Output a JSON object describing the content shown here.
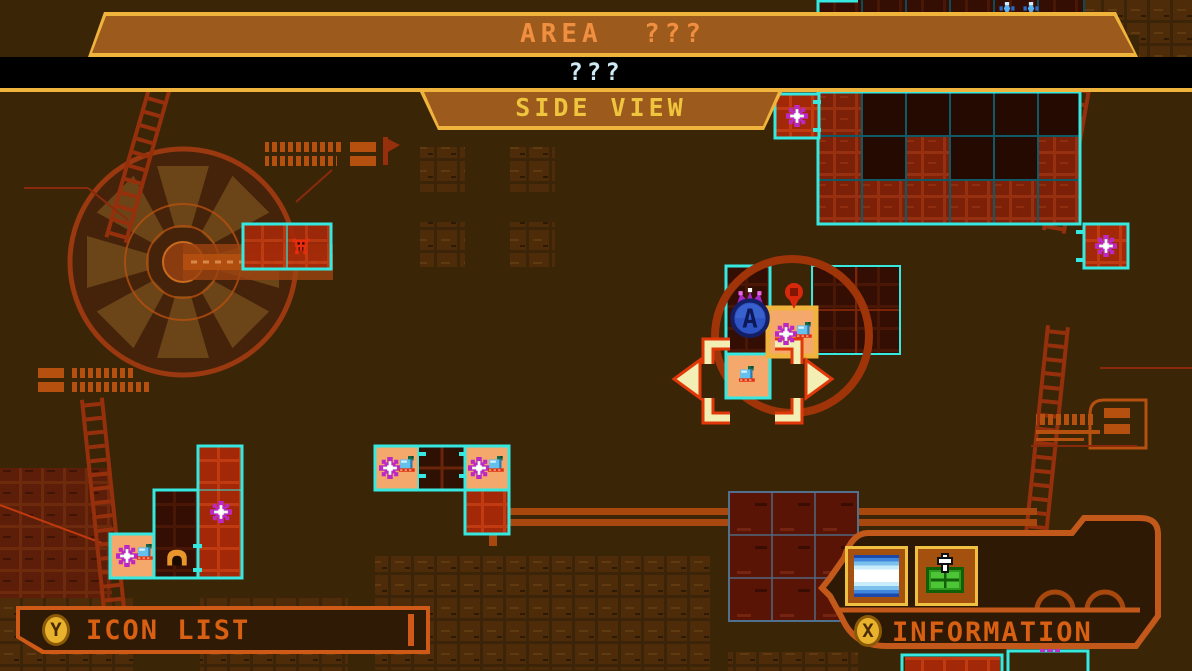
{
  "header": {
    "area_label": "AREA  ???",
    "subtitle": "???",
    "view_label": "SIDE VIEW"
  },
  "panels": {
    "icon_list": {
      "button_key": "Y",
      "label": "ICON LIST"
    },
    "information": {
      "button_key": "X",
      "label": "INFORMATION",
      "slots": [
        {
          "icon": "waterfall-icon"
        },
        {
          "icon": "map-chip-icon"
        }
      ]
    }
  },
  "map": {
    "markers": [
      {
        "type": "skull",
        "x": 301,
        "y": 247
      },
      {
        "type": "flower",
        "x": 797,
        "y": 116
      },
      {
        "type": "flower",
        "x": 1106,
        "y": 246
      },
      {
        "type": "flower",
        "x": 786,
        "y": 334
      },
      {
        "type": "tank",
        "x": 805,
        "y": 331
      },
      {
        "type": "tank",
        "x": 748,
        "y": 375
      },
      {
        "type": "flower",
        "x": 221,
        "y": 512
      },
      {
        "type": "flower",
        "x": 127,
        "y": 556
      },
      {
        "type": "tank",
        "x": 146,
        "y": 553
      },
      {
        "type": "dome",
        "x": 177,
        "y": 557
      },
      {
        "type": "flower",
        "x": 390,
        "y": 468
      },
      {
        "type": "tank",
        "x": 408,
        "y": 465
      },
      {
        "type": "flower",
        "x": 479,
        "y": 468
      },
      {
        "type": "tank",
        "x": 497,
        "y": 465
      },
      {
        "type": "sparkle",
        "x": 1007,
        "y": 9
      },
      {
        "type": "sparkle",
        "x": 1031,
        "y": 9
      },
      {
        "type": "pin",
        "x": 794,
        "y": 292
      },
      {
        "type": "player",
        "x": 750,
        "y": 318
      }
    ]
  },
  "colors": {
    "background": "#3a2507",
    "banner_fill": "#9c5a1d",
    "gold": "#f0b43c",
    "area_text": "#ef8f3f",
    "subtitle_text": "#cfeaf4",
    "tab_text": "#efc53e",
    "cyan_outline": "#35e8e0",
    "room_red": "#7c2007",
    "room_dark": "#340e03",
    "highlight_cell": "#f5a86b",
    "ring": "#9e3408",
    "bracket": "#f2eeb4",
    "bracket_outline": "#e03808",
    "panel_border": "#c2581a",
    "panel_label": "#d95f12",
    "badge_gold": "#e8b22c",
    "slate_outline": "#51708e"
  }
}
